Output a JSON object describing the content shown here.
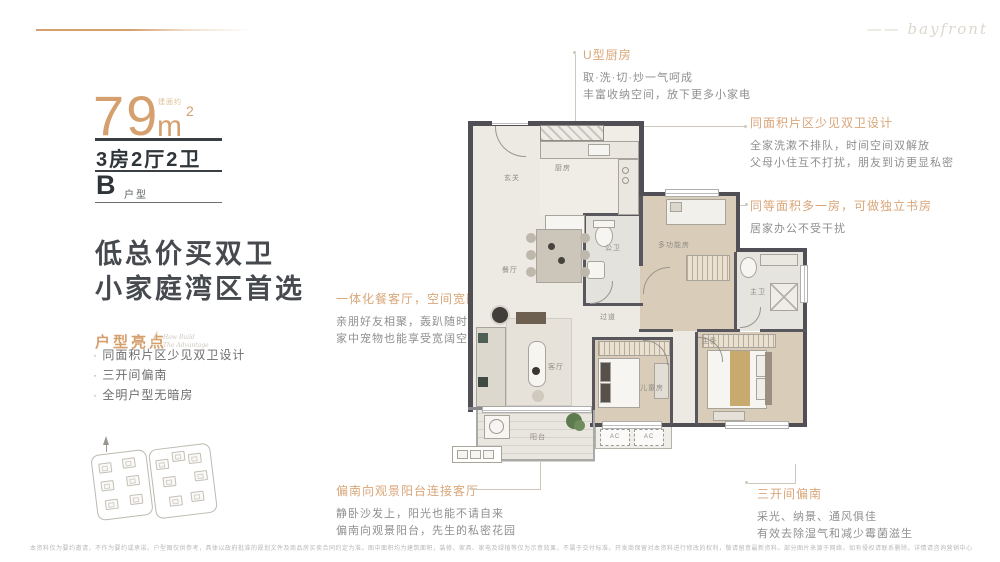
{
  "page": {
    "script_text": "bayfront",
    "dash": "——"
  },
  "left_panel": {
    "area_number": "79",
    "area_note": "建面约",
    "area_unit": "m",
    "area_sup": "2",
    "spec": "3房2厅2卫",
    "type_letter": "B",
    "type_label": "户型",
    "headline_line1": "低总价买双卫",
    "headline_line2": "小家庭湾区首选",
    "highlights_title": "户型亮点",
    "highlights_script1": "How Build",
    "highlights_script2": "The Advantage",
    "bullets": [
      "同面积片区少见双卫设计",
      "三开间偏南",
      "全明户型无暗房"
    ]
  },
  "annotations": {
    "kitchen": {
      "title": "U型厨房",
      "lines": [
        "取·洗·切·炒一气呵成",
        "丰富收纳空间，放下更多小家电"
      ]
    },
    "twin_bath": {
      "title": "同面积片区少见双卫设计",
      "lines": [
        "全家洗漱不排队，时间空间双解放",
        "父母小住互不打扰，朋友到访更显私密"
      ]
    },
    "extra_room": {
      "title": "同等面积多一房，可做独立书房",
      "lines": [
        "居家办公不受干扰"
      ]
    },
    "living": {
      "title": "一体化餐客厅，空间宽敞通透",
      "lines": [
        "亲朋好友相聚，轰趴随时开场",
        "家中宠物也能享受宽阔空间"
      ]
    },
    "balcony": {
      "title": "偏南向观景阳台连接客厅",
      "lines": [
        "静卧沙发上，阳光也能不请自来",
        "偏南向观景阳台，先生的私密花园"
      ]
    },
    "south": {
      "title": "三开间偏南",
      "lines": [
        "采光、纳景、通风俱佳",
        "有效去除湿气和减少霉菌滋生"
      ]
    }
  },
  "floorplan": {
    "rooms": {
      "entry": "玄关",
      "kitchen": "厨房",
      "dining": "餐厅",
      "guest_bath": "公卫",
      "multi": "多功能房",
      "master_bath": "主卫",
      "corridor": "过道",
      "living": "客厅",
      "kids": "儿童房",
      "master": "主卧",
      "balcony": "阳台"
    },
    "ac_label": "AC"
  },
  "disclaimer": "本资料仅为要约邀请，不作为要约或承诺。户型图仅供参考，具体以政府批准的规划文件及商品房买卖合同约定为准。图中面积均为建筑面积，装修、家具、家电及绿植等仅为示意效果，不属于交付标准。开发商保留对本资料进行修改的权利，敬请留意最新资料。部分图片来源于网络，如有侵权请联系删除。详情请咨询营销中心。"
}
